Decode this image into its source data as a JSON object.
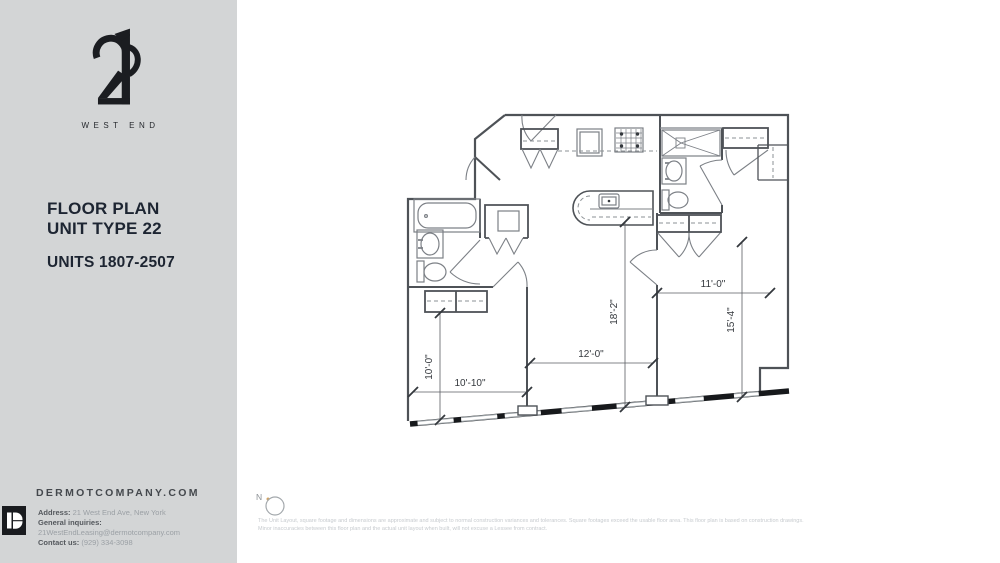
{
  "sidebar": {
    "logo": {
      "numeral": "21",
      "wordmark": "WEST END"
    },
    "title_line1": "FLOOR PLAN",
    "title_line2": "UNIT TYPE 22",
    "units_line": "UNITS 1807-2507",
    "website": "DERMOTCOMPANY.COM",
    "contact": {
      "address_label": "Address:",
      "address_value": " 21 West End Ave, New York",
      "inquiries_label": "General inquiries:",
      "inquiries_value": " 21WestEndLeasing@dermotcompany.com",
      "contact_label": "Contact us:",
      "contact_value": " (929) 334-3098"
    }
  },
  "plan": {
    "compass_label": "N",
    "dimensions": {
      "bedroom1_height": "10'-0\"",
      "bedroom1_width": "10'-10\"",
      "living_width": "12'-0\"",
      "living_height": "18'-2\"",
      "bedroom2_width": "11'-0\"",
      "bedroom2_height": "15'-4\""
    }
  },
  "disclaimer": {
    "line1": "The Unit Layout, square footage and dimensions are approximate and subject to normal construction variances and tolerances. Square footages exceed the usable floor area. This floor plan is based on construction drawings.",
    "line2": "Minor inaccuracies between this floor plan and the actual unit layout when built, will not excuse a Lessee from contract."
  },
  "colors": {
    "sidebar_bg": "#d3d5d6",
    "title_text": "#1d2532",
    "wall_line": "#4e5257",
    "window_band": "#17191c",
    "compass_dot": "#d0a468"
  }
}
